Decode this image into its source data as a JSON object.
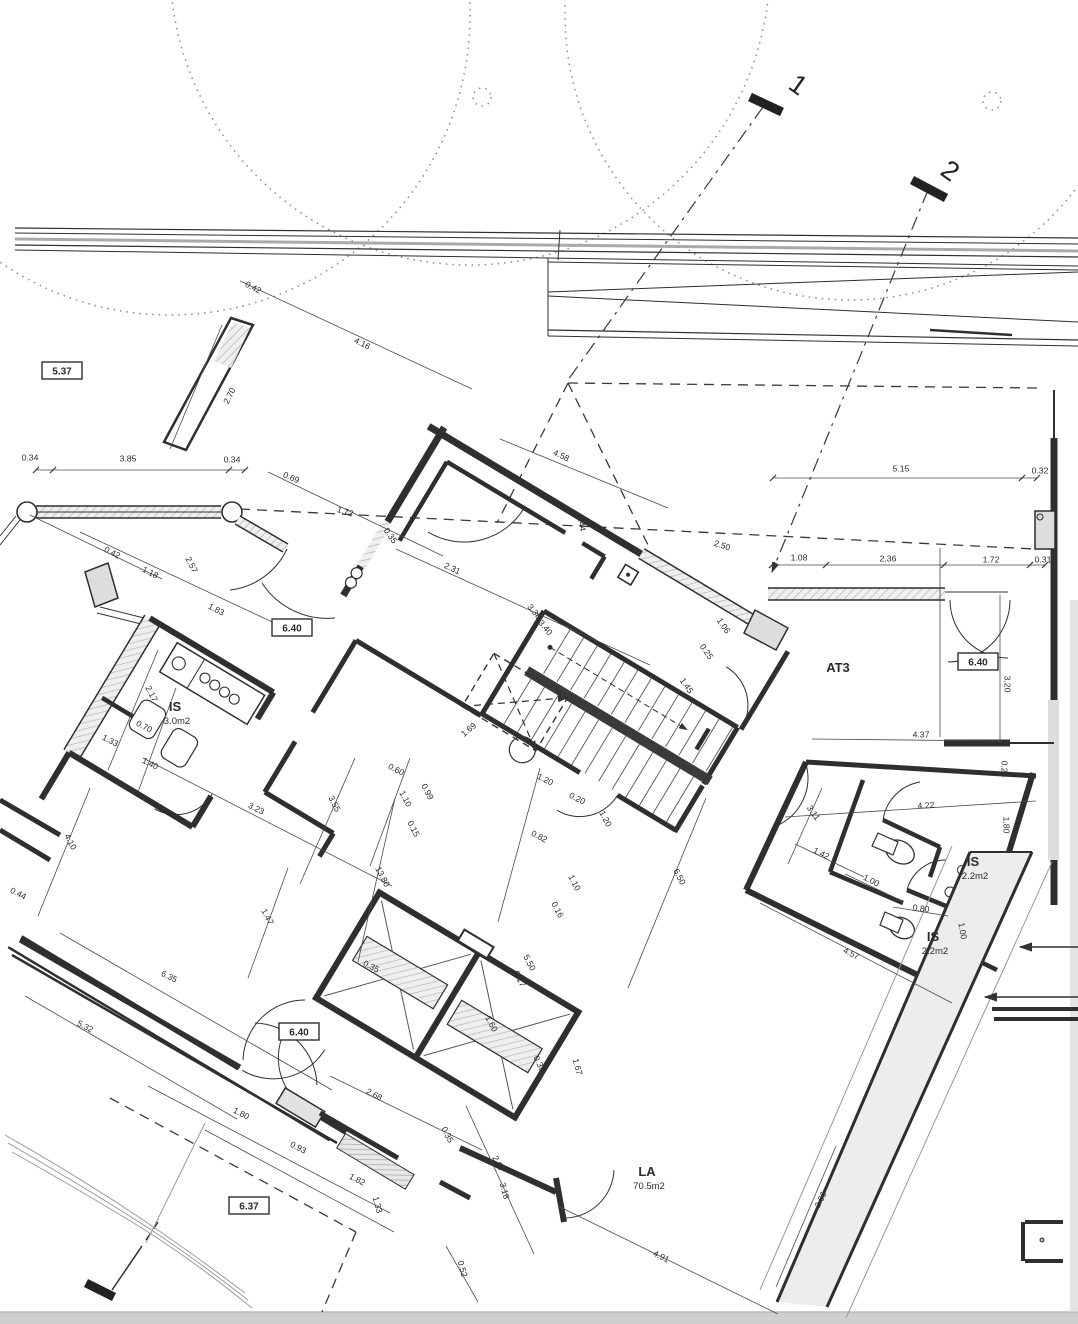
{
  "drawing": {
    "kind": "architectural floor plan (scanned blueprint)",
    "colors": {
      "ink": "#2f2f2f",
      "thin_line": "#555555",
      "hatch": "#bbbbbb",
      "scan_edge": "#cfcfcf"
    }
  },
  "rooms": [
    {
      "name": "IS",
      "area": "3.0m2",
      "x": 175,
      "y": 711,
      "rot": 0
    },
    {
      "name": "AT3",
      "area": "",
      "x": 838,
      "y": 672,
      "rot": 0
    },
    {
      "name": "IS",
      "area": "2.2m2",
      "x": 973,
      "y": 866,
      "rot": 0
    },
    {
      "name": "IS",
      "area": "2.2m2",
      "x": 933,
      "y": 941,
      "rot": 0
    },
    {
      "name": "LA",
      "area": "70.5m2",
      "x": 647,
      "y": 1176,
      "rot": 0
    }
  ],
  "boxed_labels": [
    {
      "text": "5.37",
      "x": 62,
      "y": 371
    },
    {
      "text": "6.40",
      "x": 292,
      "y": 628
    },
    {
      "text": "6.40",
      "x": 978,
      "y": 662
    },
    {
      "text": "6.40",
      "x": 299,
      "y": 1032
    },
    {
      "text": "6.37",
      "x": 249,
      "y": 1206
    }
  ],
  "section_markers": [
    {
      "label": "1",
      "x": 793,
      "y": 92,
      "rot": 35
    },
    {
      "label": "2",
      "x": 945,
      "y": 178,
      "rot": 35
    }
  ],
  "dimensions": [
    {
      "t": "0.42",
      "x": 253,
      "y": 288,
      "r": 27
    },
    {
      "t": "4.16",
      "x": 362,
      "y": 344,
      "r": 27
    },
    {
      "t": "2.70",
      "x": 230,
      "y": 396,
      "r": -63
    },
    {
      "t": "0.34",
      "x": 30,
      "y": 458,
      "r": 0
    },
    {
      "t": "3.85",
      "x": 128,
      "y": 459,
      "r": 0
    },
    {
      "t": "0.34",
      "x": 232,
      "y": 460,
      "r": 0
    },
    {
      "t": "0.69",
      "x": 291,
      "y": 478,
      "r": 23
    },
    {
      "t": "1.72",
      "x": 345,
      "y": 512,
      "r": 17
    },
    {
      "t": "0.35",
      "x": 390,
      "y": 536,
      "r": 55
    },
    {
      "t": "2.31",
      "x": 452,
      "y": 569,
      "r": 25
    },
    {
      "t": "4.58",
      "x": 561,
      "y": 456,
      "r": 25
    },
    {
      "t": "0.44",
      "x": 581,
      "y": 523,
      "r": 80
    },
    {
      "t": "2.50",
      "x": 722,
      "y": 546,
      "r": 18
    },
    {
      "t": "1.08",
      "x": 799,
      "y": 558,
      "r": 0
    },
    {
      "t": "2.36",
      "x": 888,
      "y": 559,
      "r": 0
    },
    {
      "t": "1.72",
      "x": 991,
      "y": 560,
      "r": 0
    },
    {
      "t": "0.31",
      "x": 1043,
      "y": 560,
      "r": 0
    },
    {
      "t": "5.15",
      "x": 901,
      "y": 469,
      "r": 0
    },
    {
      "t": "0.32",
      "x": 1040,
      "y": 471,
      "r": 0
    },
    {
      "t": "1.06",
      "x": 723,
      "y": 626,
      "r": 55
    },
    {
      "t": "0.25",
      "x": 706,
      "y": 652,
      "r": 55
    },
    {
      "t": "1.45",
      "x": 686,
      "y": 686,
      "r": 55
    },
    {
      "t": "3.36",
      "x": 534,
      "y": 612,
      "r": 50
    },
    {
      "t": "3.40",
      "x": 545,
      "y": 628,
      "r": 50
    },
    {
      "t": "0.42",
      "x": 112,
      "y": 553,
      "r": 27
    },
    {
      "t": "1.18",
      "x": 150,
      "y": 573,
      "r": 27
    },
    {
      "t": "2.57",
      "x": 191,
      "y": 565,
      "r": 62
    },
    {
      "t": "1.83",
      "x": 216,
      "y": 610,
      "r": 27
    },
    {
      "t": "3.20",
      "x": 1007,
      "y": 684,
      "r": 90
    },
    {
      "t": "4.37",
      "x": 921,
      "y": 735,
      "r": 0
    },
    {
      "t": "4.22",
      "x": 926,
      "y": 806,
      "r": -4
    },
    {
      "t": "3.11",
      "x": 813,
      "y": 813,
      "r": 55
    },
    {
      "t": "1.42",
      "x": 821,
      "y": 854,
      "r": 27
    },
    {
      "t": "1.80",
      "x": 1006,
      "y": 825,
      "r": 90
    },
    {
      "t": "1.00",
      "x": 871,
      "y": 881,
      "r": 27
    },
    {
      "t": "0.80",
      "x": 921,
      "y": 909,
      "r": 8
    },
    {
      "t": "1.00",
      "x": 962,
      "y": 931,
      "r": 80
    },
    {
      "t": "4.57",
      "x": 851,
      "y": 954,
      "r": 27
    },
    {
      "t": "0.24",
      "x": 1004,
      "y": 769,
      "r": 90
    },
    {
      "t": "2.17",
      "x": 151,
      "y": 694,
      "r": 62
    },
    {
      "t": "0.70",
      "x": 144,
      "y": 727,
      "r": 27
    },
    {
      "t": "1.33",
      "x": 110,
      "y": 741,
      "r": 27
    },
    {
      "t": "1.40",
      "x": 150,
      "y": 764,
      "r": 27
    },
    {
      "t": "0.15",
      "x": 413,
      "y": 829,
      "r": 62
    },
    {
      "t": "1.10",
      "x": 405,
      "y": 799,
      "r": 62
    },
    {
      "t": "0.99",
      "x": 427,
      "y": 792,
      "r": 62
    },
    {
      "t": "0.60",
      "x": 396,
      "y": 770,
      "r": 27
    },
    {
      "t": "1.20",
      "x": 545,
      "y": 780,
      "r": 27
    },
    {
      "t": "0.20",
      "x": 577,
      "y": 799,
      "r": 27
    },
    {
      "t": "1.20",
      "x": 605,
      "y": 819,
      "r": 62
    },
    {
      "t": "13.80",
      "x": 382,
      "y": 877,
      "r": 62
    },
    {
      "t": "0.82",
      "x": 539,
      "y": 837,
      "r": 27
    },
    {
      "t": "1.10",
      "x": 574,
      "y": 883,
      "r": 62
    },
    {
      "t": "0.16",
      "x": 557,
      "y": 910,
      "r": 62
    },
    {
      "t": "6.50",
      "x": 679,
      "y": 877,
      "r": 62
    },
    {
      "t": "3.23",
      "x": 256,
      "y": 809,
      "r": 27
    },
    {
      "t": "3.55",
      "x": 334,
      "y": 804,
      "r": 62
    },
    {
      "t": "4.10",
      "x": 70,
      "y": 842,
      "r": 62
    },
    {
      "t": "0.44",
      "x": 18,
      "y": 894,
      "r": 27
    },
    {
      "t": "1.47",
      "x": 267,
      "y": 917,
      "r": 62
    },
    {
      "t": "6.35",
      "x": 169,
      "y": 977,
      "r": 27
    },
    {
      "t": "5.32",
      "x": 85,
      "y": 1027,
      "r": 27
    },
    {
      "t": "1.69",
      "x": 469,
      "y": 730,
      "r": -40
    },
    {
      "t": "1.60",
      "x": 491,
      "y": 1024,
      "r": 62
    },
    {
      "t": "0.17",
      "x": 519,
      "y": 979,
      "r": 62
    },
    {
      "t": "5.50",
      "x": 529,
      "y": 963,
      "r": 62
    },
    {
      "t": "0.35",
      "x": 371,
      "y": 967,
      "r": 27
    },
    {
      "t": "0.35",
      "x": 539,
      "y": 1064,
      "r": 62
    },
    {
      "t": "1.67",
      "x": 577,
      "y": 1067,
      "r": 75
    },
    {
      "t": "2.68",
      "x": 374,
      "y": 1095,
      "r": 27
    },
    {
      "t": "0.35",
      "x": 447,
      "y": 1135,
      "r": 62
    },
    {
      "t": "2.07",
      "x": 498,
      "y": 1164,
      "r": 62
    },
    {
      "t": "3.18",
      "x": 504,
      "y": 1191,
      "r": 75
    },
    {
      "t": "0.52",
      "x": 462,
      "y": 1269,
      "r": 75
    },
    {
      "t": "1.80",
      "x": 241,
      "y": 1114,
      "r": 27
    },
    {
      "t": "0.93",
      "x": 298,
      "y": 1148,
      "r": 27
    },
    {
      "t": "1.82",
      "x": 357,
      "y": 1180,
      "r": 27
    },
    {
      "t": "1.33",
      "x": 377,
      "y": 1205,
      "r": 75
    },
    {
      "t": "4.91",
      "x": 661,
      "y": 1257,
      "r": 27
    },
    {
      "t": "2.66",
      "x": 821,
      "y": 1200,
      "r": -63
    }
  ]
}
